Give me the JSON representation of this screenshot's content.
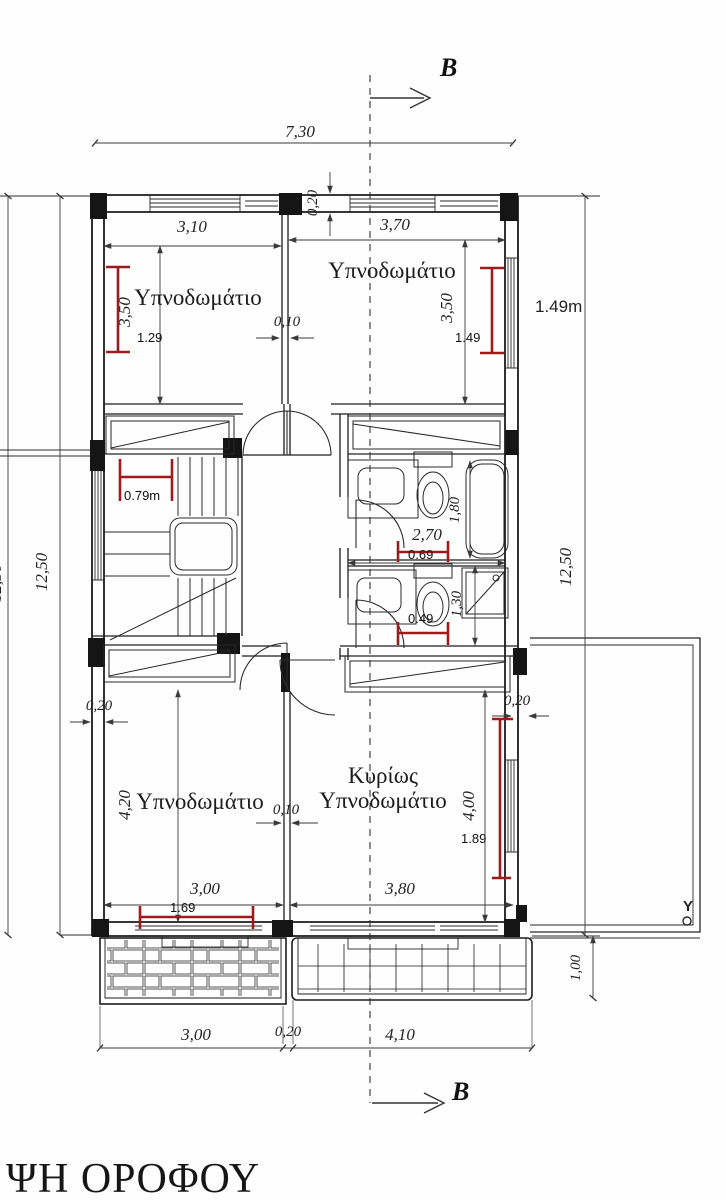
{
  "drawing": {
    "title": "ΨΗ ΟΡΟΦΟΥ",
    "section_marker_top": "B",
    "section_marker_bottom": "B",
    "terrace_point_label": "Y",
    "colors": {
      "ink": "#1b1b1b",
      "dim_ink": "#3a3a3a",
      "red_annotation": "#9e1b1b",
      "paper": "#fefefe"
    },
    "rooms": [
      {
        "id": "bedroom-top-left",
        "label": "Υπνοδωμάτιο"
      },
      {
        "id": "bedroom-top-right",
        "label": "Υπνοδωμάτιο"
      },
      {
        "id": "bedroom-bottom-left",
        "label": "Υπνοδωμάτιο"
      },
      {
        "id": "master-bedroom",
        "label_line1": "Κυρίως",
        "label_line2": "Υπνοδωμάτιο"
      }
    ],
    "dimensions": {
      "top_overall": "7,30",
      "top_wall_thickness": "0,20",
      "bedroom_tl_width": "3,10",
      "bedroom_tr_width": "3,70",
      "bedroom_tl_depth": "3,50",
      "bedroom_tr_depth": "3,50",
      "partition_top": "0,10",
      "left_height_outer": "12,50",
      "left_height": "12,50",
      "right_height": "12,50",
      "bath_width": "2,70",
      "bath_depth": "1,80",
      "bath_lower_depth": "1,30",
      "left_wall_thickness": "0,20",
      "right_wall_thickness": "0,20",
      "bedroom_bl_depth": "4,20",
      "master_depth": "4,00",
      "partition_bottom": "0,10",
      "bedroom_bl_width": "3,00",
      "master_width": "3,80",
      "balcony_depth": "1,00",
      "bottom_left_width": "3,00",
      "bottom_gap": "0,20",
      "bottom_right_width": "4,10"
    },
    "red_measurements": {
      "bedroom_tl": "1.29",
      "bedroom_tr": "1.49",
      "bedroom_tr_outside": "1.49m",
      "stair_hall": "0.79m",
      "bath_mid": "0.69",
      "bath_lower": "0.49",
      "bedroom_bl": "1.69",
      "master": "1.89"
    }
  }
}
